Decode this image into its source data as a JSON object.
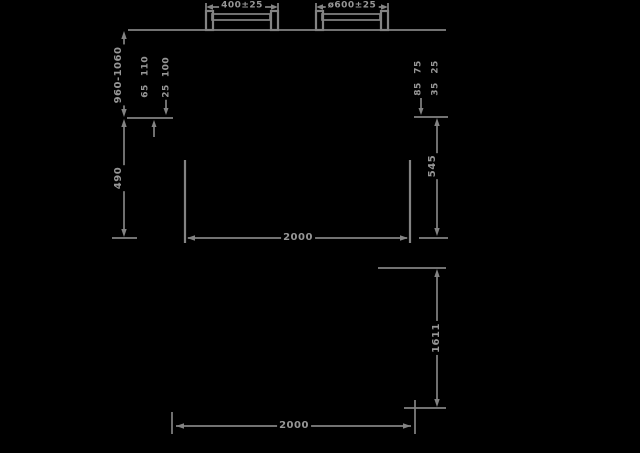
{
  "colors": {
    "background": "#000000",
    "line": "#838383",
    "text": "#969696"
  },
  "front_view": {
    "bracket_left_dim": "400±25",
    "bracket_right_dim": "ø600±25",
    "height_range": "960-1060",
    "small_dims_left": {
      "a": "110",
      "b": "65",
      "c": "100",
      "d": "25"
    },
    "lower_height_left": "490",
    "small_dims_right": {
      "a": "75",
      "b": "25",
      "c": "85",
      "d": "35"
    },
    "lower_height_right": "545",
    "overall_width": "2000"
  },
  "plan_view": {
    "depth": "1611",
    "width": "2000"
  }
}
